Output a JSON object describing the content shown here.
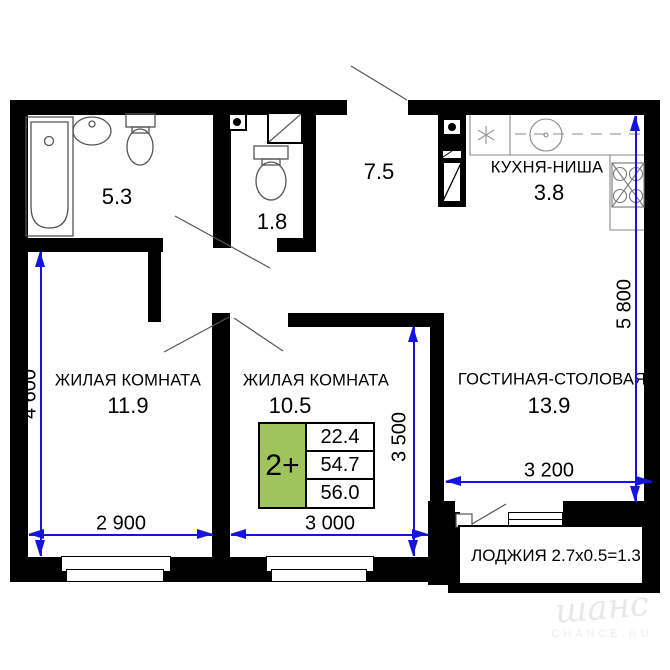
{
  "rooms": {
    "bathroom": {
      "area": "5.3"
    },
    "wc": {
      "area": "1.8"
    },
    "hall": {
      "area": "7.5"
    },
    "kitchen": {
      "label": "КУХНЯ-НИША",
      "area": "3.8"
    },
    "bedroom1": {
      "label": "ЖИЛАЯ КОМНАТА",
      "area": "11.9"
    },
    "bedroom2": {
      "label": "ЖИЛАЯ КОМНАТА",
      "area": "10.5"
    },
    "living_dining": {
      "label": "ГОСТИНАЯ-СТОЛОВАЯ",
      "area": "13.9"
    },
    "loggia": {
      "label": "ЛОДЖИЯ 2.7x0.5=1.3"
    }
  },
  "dimensions": {
    "left_height": "4 600",
    "bedroom2_height": "3 500",
    "right_height": "5 800",
    "bedroom1_width": "2 900",
    "bedroom2_width": "3 000",
    "living_width": "3 200"
  },
  "apartment_summary": {
    "type_label": "2+",
    "living_area": "22.4",
    "area_without_loggia": "54.7",
    "total_area": "56.0"
  },
  "watermark": {
    "brand": "шанс",
    "site": "CHANCE.RU"
  },
  "colors": {
    "wall": "#000000",
    "dimension_blue": "#1414dd",
    "summary_green": "#9fc45c",
    "fixture_gray": "#555555"
  }
}
